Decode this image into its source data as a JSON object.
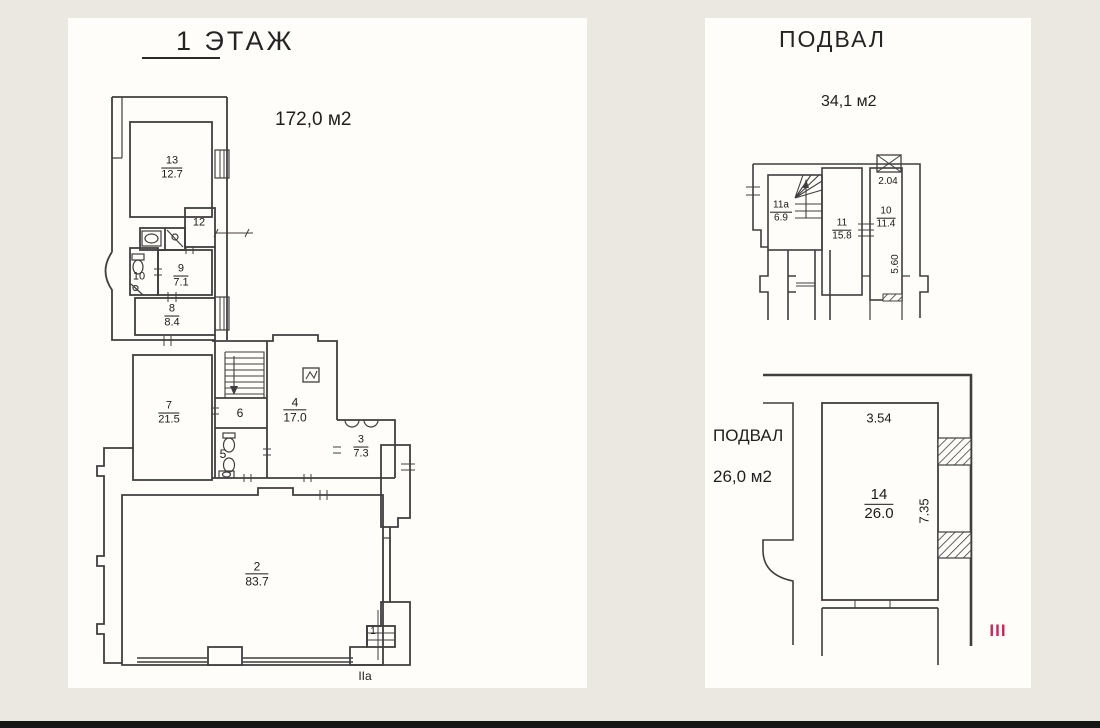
{
  "page": {
    "background": "#ebe8e1",
    "panel_background": "#fffdf9",
    "line_color": "#3f3f3f",
    "accent_red": "#c22a5c",
    "bottom_bar_color": "#161616"
  },
  "floor1": {
    "title": "1 ЭТАЖ",
    "total_area": "172,0 м2",
    "entrance_label": "IIa",
    "rooms": [
      {
        "number": "13",
        "area": "12.7"
      },
      {
        "number": "12",
        "area": ""
      },
      {
        "number": "10",
        "area": ""
      },
      {
        "number": "9",
        "area": "7.1"
      },
      {
        "number": "8",
        "area": "8.4"
      },
      {
        "number": "7",
        "area": "21.5"
      },
      {
        "number": "6",
        "area": ""
      },
      {
        "number": "5",
        "area": ""
      },
      {
        "number": "4",
        "area": "17.0"
      },
      {
        "number": "3",
        "area": "7.3"
      },
      {
        "number": "2",
        "area": "83.7"
      },
      {
        "number": "1",
        "area": ""
      }
    ]
  },
  "basement": {
    "title": "ПОДВАЛ",
    "upper_total_area": "34,1 м2",
    "upper_rooms": [
      {
        "number": "11а",
        "area": "6.9"
      },
      {
        "number": "11",
        "area": "15.8"
      },
      {
        "number": "10",
        "area": "11.4"
      }
    ],
    "upper_dimensions": {
      "width": "2.04",
      "height": "5.60"
    },
    "lower_label": "ПОДВАЛ",
    "lower_total_area": "26,0 м2",
    "lower_room": {
      "number": "14",
      "area": "26.0"
    },
    "lower_dimensions": {
      "width": "3.54",
      "height": "7.35"
    },
    "section_mark": "III"
  }
}
